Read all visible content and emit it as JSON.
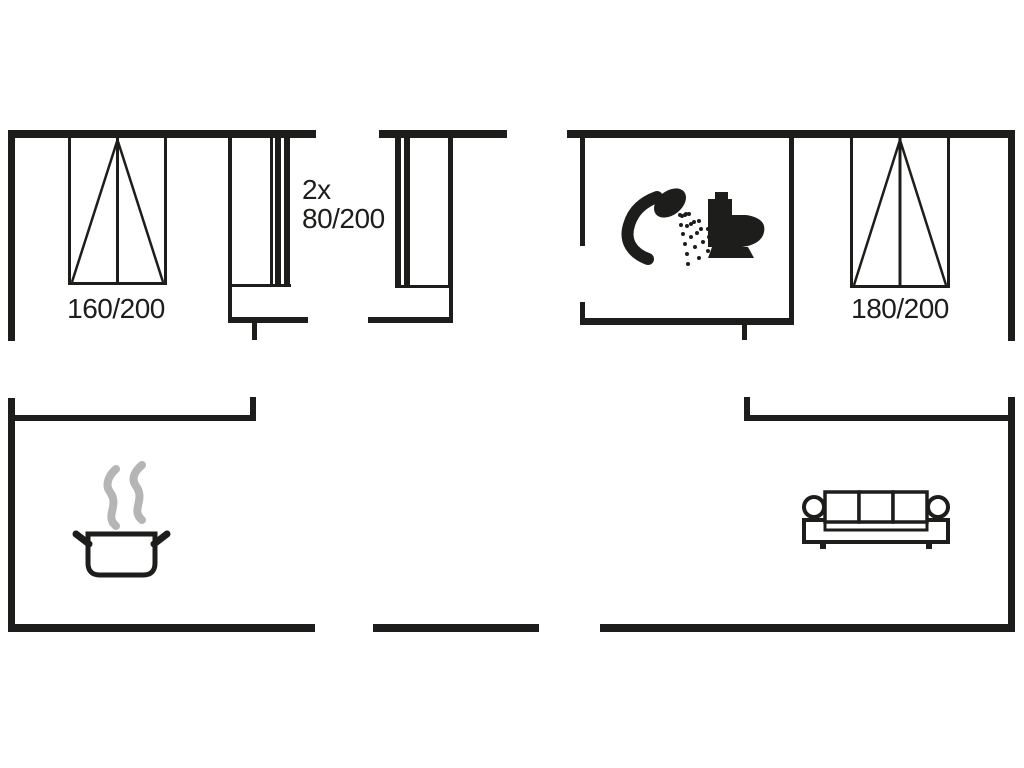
{
  "floorplan": {
    "labels": {
      "bed_left_size": "160/200",
      "single_beds_count": "2x",
      "single_beds_size": "80/200",
      "bed_right_size": "180/200"
    },
    "colors": {
      "wall": "#1d1d1b",
      "background": "#ffffff",
      "steam": "#b5b5b5"
    },
    "icons": [
      "double-bed-icon",
      "single-bed-icon",
      "shower-icon",
      "toilet-icon",
      "cooking-pot-icon",
      "steam-icon",
      "sofa-icon"
    ]
  }
}
